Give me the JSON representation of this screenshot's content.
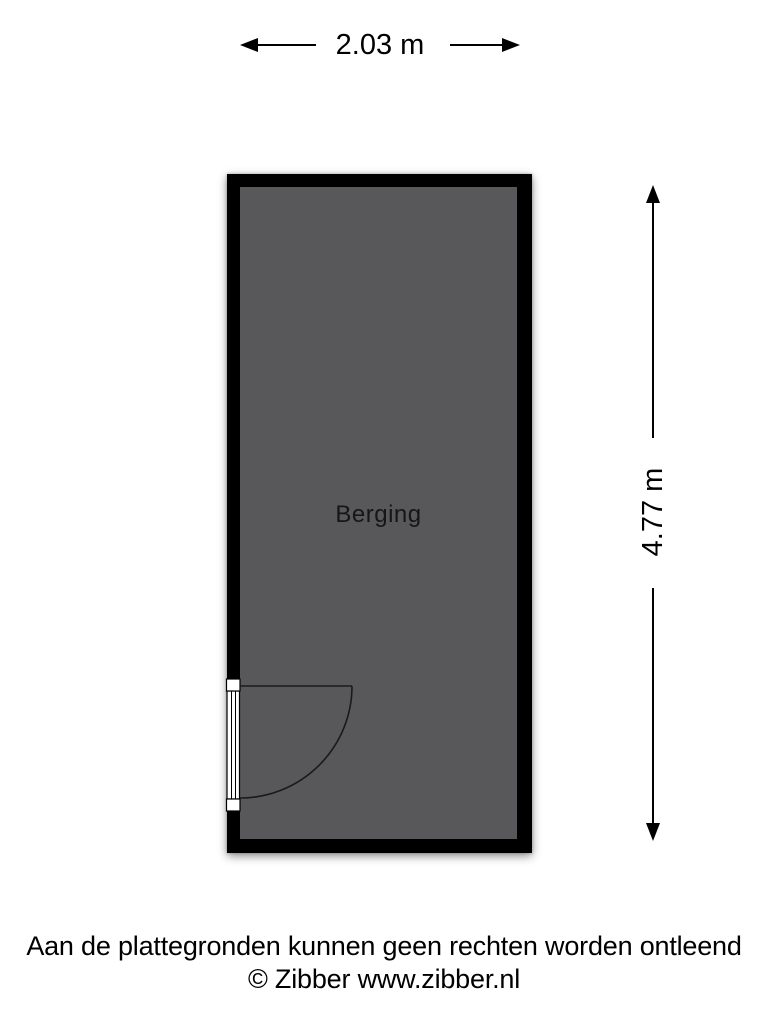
{
  "dimensions": {
    "width_label": "2.03 m",
    "height_label": "4.77 m"
  },
  "room": {
    "label": "Berging"
  },
  "footer": {
    "disclaimer": "Aan de plattegronden kunnen geen rechten worden ontleend",
    "credit": "© Zibber www.zibber.nl"
  },
  "colors": {
    "wall": "#000000",
    "room_fill": "#58585A",
    "background": "#FFFFFF",
    "label_text": "#161616",
    "dimension_text": "#000000"
  }
}
